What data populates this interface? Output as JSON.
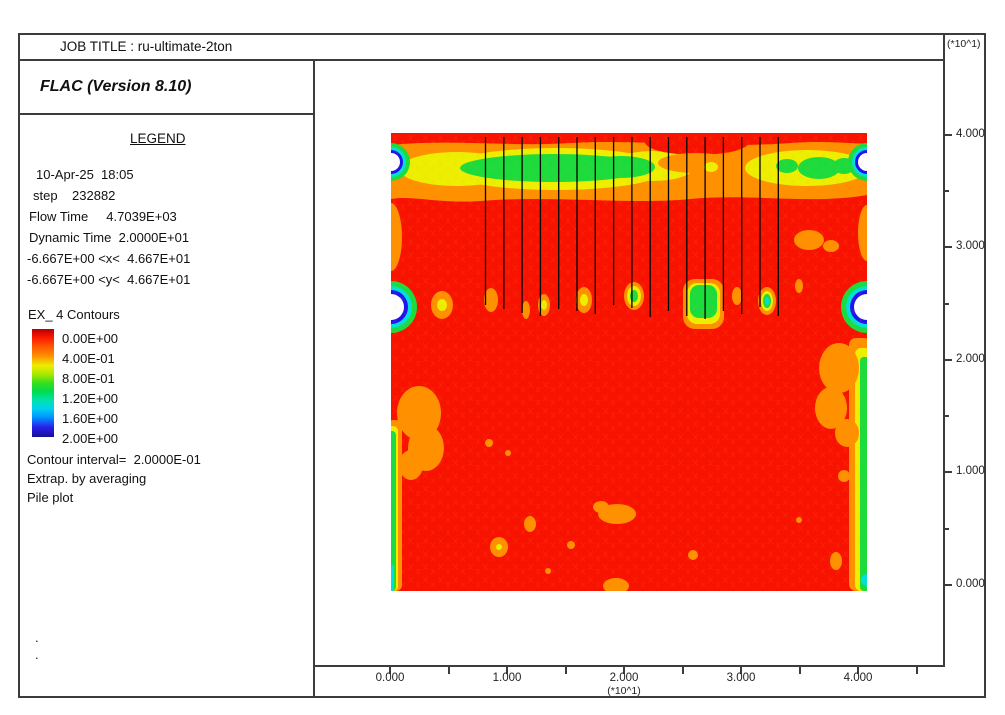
{
  "window": {
    "job_title": "JOB TITLE : ru-ultimate-2ton"
  },
  "header": {
    "app_title": "FLAC (Version 8.10)"
  },
  "legend": {
    "title": "LEGEND",
    "date_time": "10-Apr-25  18:05",
    "step": "step    232882",
    "flow_time": "Flow Time     4.7039E+03",
    "dynamic_time": "Dynamic Time  2.0000E+01",
    "x_range": "-6.667E+00 <x<  4.667E+01",
    "y_range": "-6.667E+00 <y<  4.667E+01",
    "contours_title": "EX_ 4 Contours",
    "contour_levels": [
      "0.00E+00",
      "4.00E-01",
      "8.00E-01",
      "1.20E+00",
      "1.60E+00",
      "2.00E+00"
    ],
    "contour_interval": "Contour interval=  2.0000E-01",
    "extrapolation": "Extrap. by averaging",
    "plot_item": "Pile plot",
    "footer_dots": [
      ".",
      "."
    ]
  },
  "axes": {
    "multiplier": "(*10^1)",
    "x_ticks": [
      "0.000",
      "1.000",
      "2.000",
      "3.000",
      "4.000"
    ],
    "y_ticks": [
      "4.000",
      "3.000",
      "2.000",
      "1.000",
      "0.000"
    ]
  },
  "palette": {
    "contour_red": "#F81300",
    "contour_orange": "#FF9000",
    "contour_yellow": "#EDEE00",
    "contour_green": "#1BDC3C",
    "contour_cyan": "#00DFD8",
    "contour_blue": "#2012EF",
    "colorbar_navy": "#151097",
    "frame_border": "#3C3C3C"
  },
  "chart_data": {
    "type": "heatmap",
    "title": "EX_ 4 Contours",
    "variable": "EX_ 4 (excess pore pressure ratio contours)",
    "contour_levels": [
      0.0,
      0.4,
      0.8,
      1.2,
      1.6,
      2.0
    ],
    "contour_interval": 0.2,
    "step": 232882,
    "flow_time": 4703.9,
    "dynamic_time": 20.0,
    "view_x_range": [
      -6.667,
      46.67
    ],
    "view_y_range": [
      -6.667,
      46.67
    ],
    "axis_multiplier": 10,
    "x_axis_ticks": [
      0.0,
      1.0,
      2.0,
      3.0,
      4.0
    ],
    "y_axis_ticks": [
      0.0,
      1.0,
      2.0,
      3.0,
      4.0
    ],
    "model_extent_units": [
      0,
      40
    ],
    "piles": {
      "count": 17,
      "x_first_units": 8.1,
      "x_last_units": 33.1,
      "top_units": 39.7,
      "bottom_units": 24.8
    },
    "field_description": "Field dominated by level 0.0 (red); elevated band 0.4-0.8 (orange/yellow/green) across top near y=37; row of small 0.4-1.2 blobs at pile tips near y=25; peaks to 2.0 (blue/white) at left and right boundaries near y=38 and y=25; thin 0.4-0.8 strips along lower left and right edges; scattered 0.4 spots in lower half",
    "legend_position": "left panel",
    "grid": false
  }
}
